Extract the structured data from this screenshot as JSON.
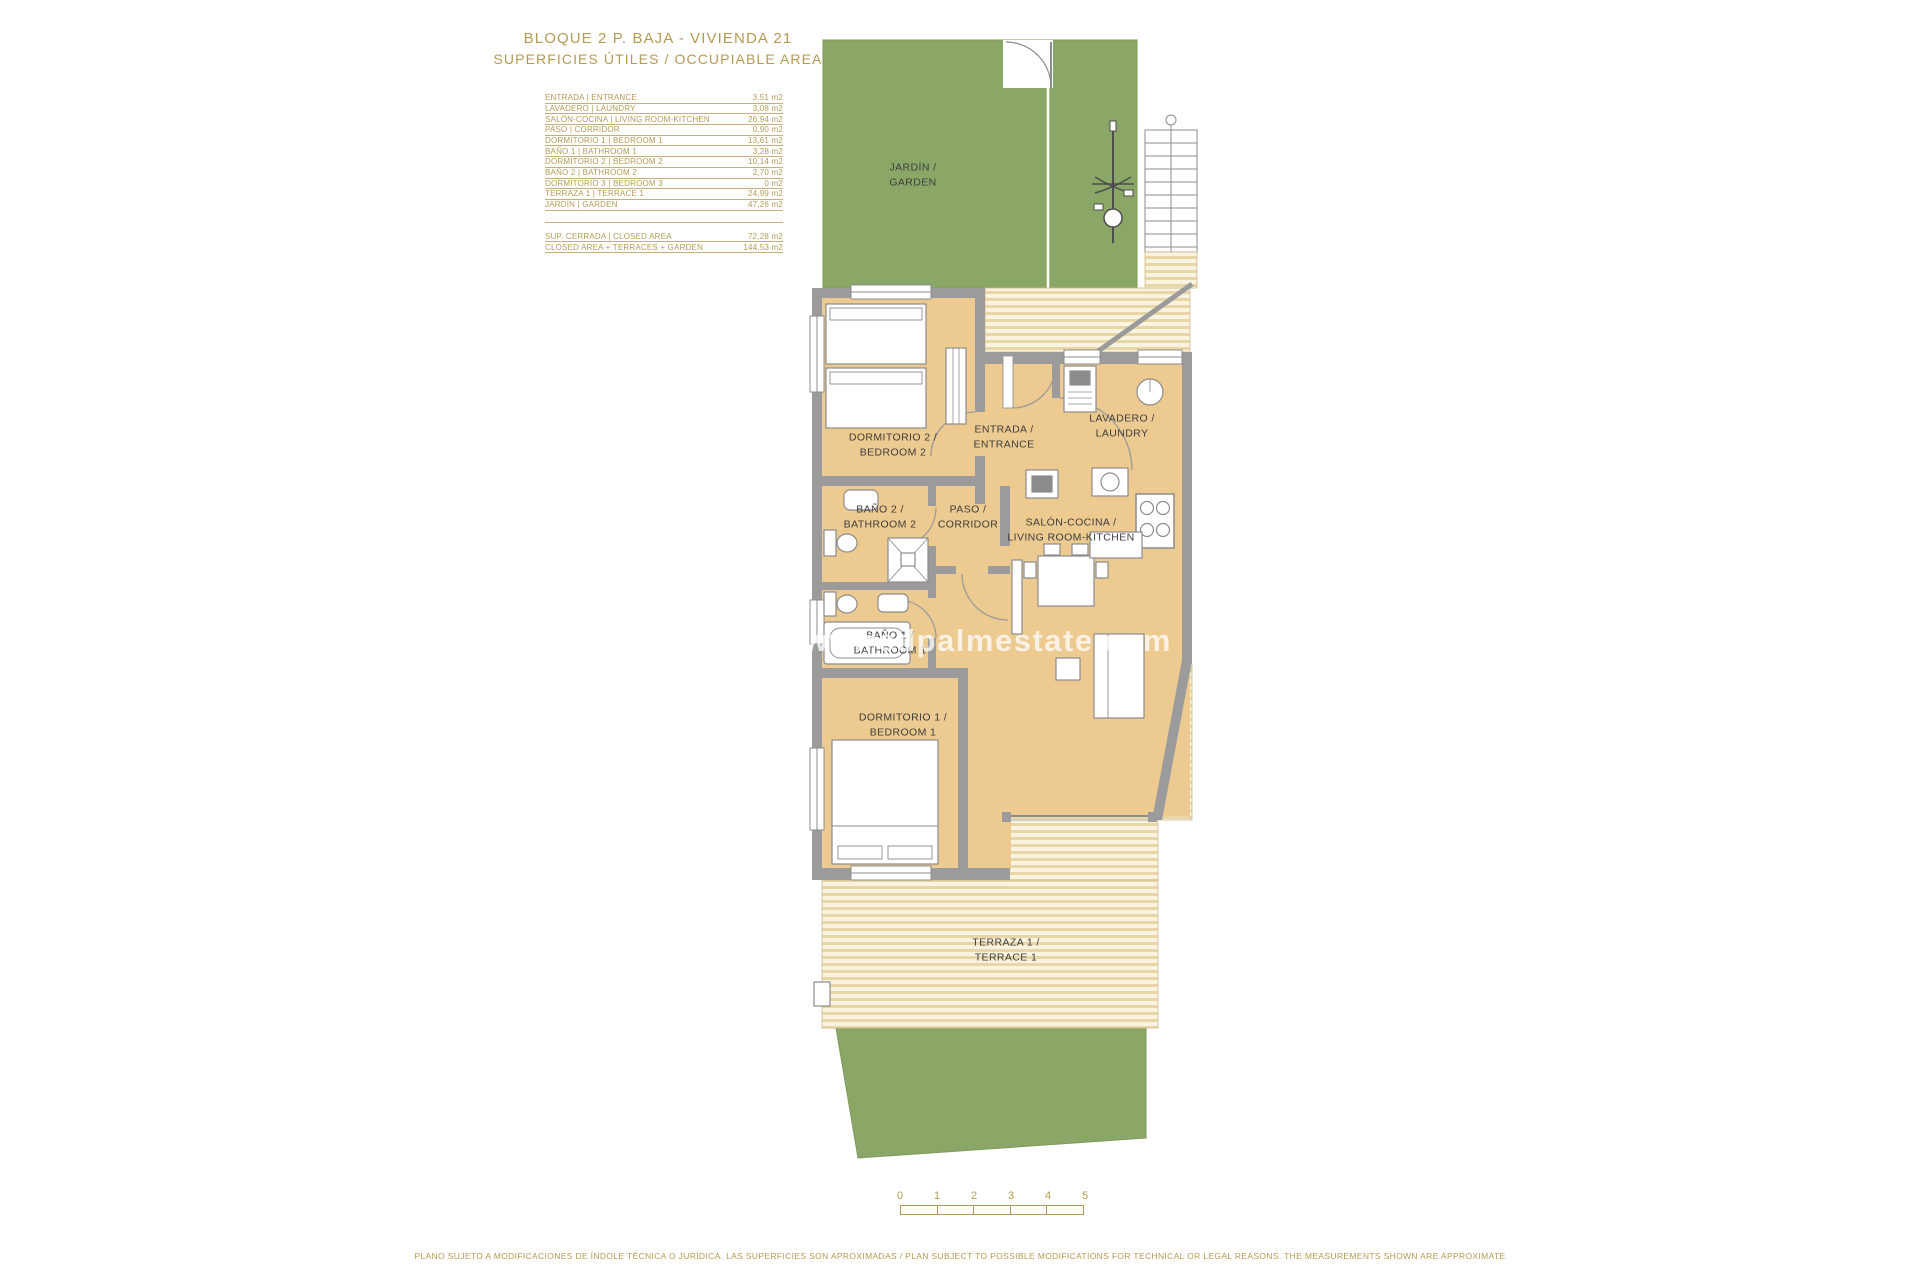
{
  "title": {
    "line1": "BLOQUE 2 P. BAJA - VIVIENDA 21",
    "line2": "SUPERFICIES ÚTILES / OCCUPIABLE AREA"
  },
  "area_table": {
    "rows": [
      {
        "label": "ENTRADA | ENTRANCE",
        "value": "3,51 m2"
      },
      {
        "label": "LAVADERO | LAUNDRY",
        "value": "3,08 m2"
      },
      {
        "label": "SALÓN-COCINA | LIVING ROOM-KITCHEN",
        "value": "26,94 m2"
      },
      {
        "label": "PASO | CORRIDOR",
        "value": "0,90 m2"
      },
      {
        "label": "DORMITORIO 1 | BEDROOM 1",
        "value": "13,61 m2"
      },
      {
        "label": "BAÑO 1 | BATHROOM 1",
        "value": "3,28 m2"
      },
      {
        "label": "DORMITORIO 2 | BEDROOM 2",
        "value": "10,14 m2"
      },
      {
        "label": "BAÑO 2 | BATHROOM 2",
        "value": "2,70 m2"
      },
      {
        "label": "DORMITORIO 3 | BEDROOM 3",
        "value": "0 m2"
      },
      {
        "label": "TERRAZA 1 | TERRACE 1",
        "value": "24,99 m2"
      },
      {
        "label": "JARDÍN | GARDEN",
        "value": "47,26 m2"
      }
    ],
    "summary_rows": [
      {
        "label": "SUP. CERRADA | CLOSED AREA",
        "value": "72,28 m2"
      },
      {
        "label": "CLOSED AREA + TERRACES + GARDEN",
        "value": "144,53 m2"
      }
    ]
  },
  "plan": {
    "rooms": {
      "jardin": {
        "line1": "JARDÍN /",
        "line2": "GARDEN"
      },
      "dormitorio2": {
        "line1": "DORMITORIO 2 /",
        "line2": "BEDROOM 2"
      },
      "entrada": {
        "line1": "ENTRADA /",
        "line2": "ENTRANCE"
      },
      "lavadero": {
        "line1": "LAVADERO /",
        "line2": "LAUNDRY"
      },
      "bano2": {
        "line1": "BAÑO 2 /",
        "line2": "BATHROOM 2"
      },
      "paso": {
        "line1": "PASO /",
        "line2": "CORRIDOR"
      },
      "salon": {
        "line1": "SALÓN-COCINA /",
        "line2": "LIVING ROOM-KITCHEN"
      },
      "bano1": {
        "line1": "BAÑO 1 /",
        "line2": "BATHROOM 1"
      },
      "dormitorio1": {
        "line1": "DORMITORIO 1 /",
        "line2": "BEDROOM 1"
      },
      "terraza1": {
        "line1": "TERRAZA 1 /",
        "line2": "TERRACE 1"
      }
    }
  },
  "watermark": {
    "text": "www.redpalmestate.com"
  },
  "scale_bar": {
    "labels": [
      "0",
      "1",
      "2",
      "3",
      "4",
      "5"
    ]
  },
  "disclaimer": {
    "text": "PLANO SUJETO A MODIFICACIONES DE ÍNDOLE TÉCNICA O JURÍDICA. LAS SUPERFICIES SON APROXIMADAS / PLAN SUBJECT TO POSSIBLE MODIFICATIONS FOR TECHNICAL OR LEGAL REASONS. THE MEASUREMENTS SHOWN ARE APPROXIMATE"
  },
  "colors": {
    "gold_text": "#b49b53",
    "garden_green": "#8ba768",
    "room_beige": "#ecca90",
    "wall_gray": "#9b9b9b",
    "stripe_light": "#faf3e0",
    "stripe_dark": "#e9d6a6",
    "label_dark": "#3d3d3d"
  }
}
